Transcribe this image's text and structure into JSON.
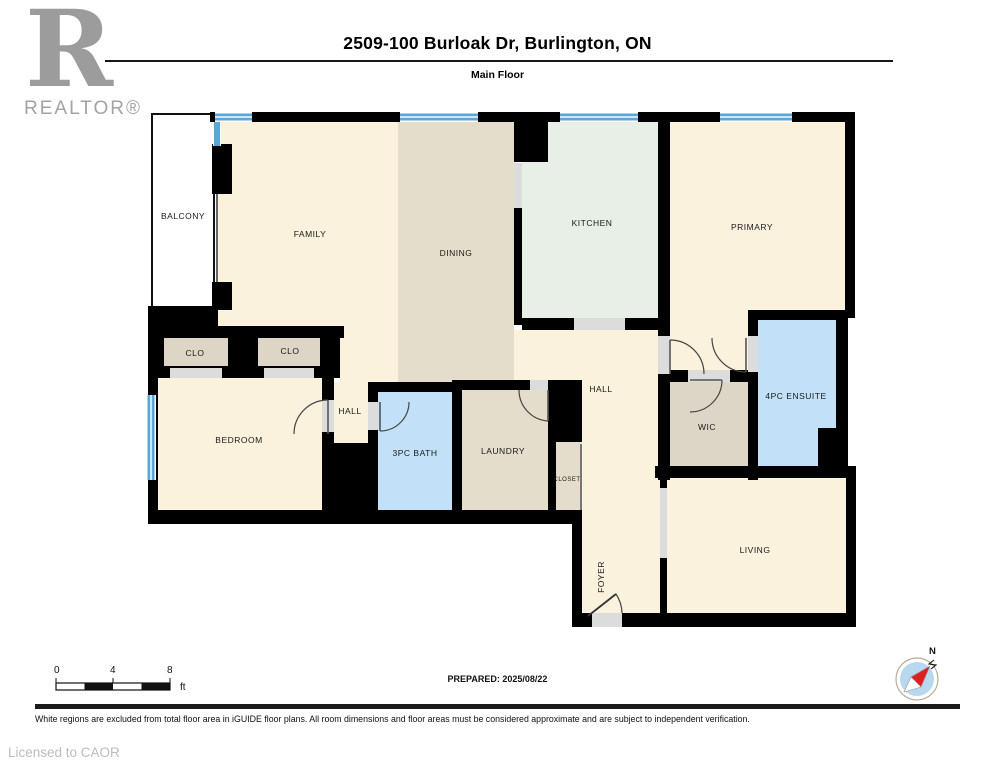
{
  "header": {
    "title": "2509-100 Burloak Dr, Burlington, ON",
    "subtitle": "Main Floor"
  },
  "branding": {
    "logo_letter": "R",
    "logo_wordmark": "REALTOR®",
    "licensed_to": "Licensed to CAOR"
  },
  "footer": {
    "prepared_label": "PREPARED: 2025/08/22",
    "disclaimer": "White regions are excluded from total floor area in iGUIDE floor plans. All room dimensions and floor areas must be considered approximate and are subject to independent verification.",
    "compass_label": "N"
  },
  "scale_bar": {
    "ticks": [
      "0",
      "4",
      "8"
    ],
    "unit": "ft"
  },
  "colors": {
    "white": "#ffffff",
    "cream": "#faf2dc",
    "tan": "#e5ddcb",
    "tan2": "#ddd5c6",
    "mint": "#e7efe6",
    "blue": "#c2e1f8",
    "window": "#5aa6d6",
    "window_light": "#cfe6f4",
    "wall": "#000000",
    "threshold": "#dcdcdc",
    "label_text": "#1a1a1a"
  },
  "floorplan": {
    "rooms": [
      {
        "name": "balcony",
        "label": "BALCONY",
        "rect": [
          152,
          114,
          62,
          196
        ],
        "color": "white",
        "outline": true,
        "label_pos": [
          183,
          219
        ]
      },
      {
        "name": "family",
        "label": "FAMILY",
        "rect": [
          218,
          122,
          180,
          206
        ],
        "color": "cream",
        "label_pos": [
          310,
          237
        ]
      },
      {
        "name": "family-passage",
        "label": "",
        "rect": [
          340,
          326,
          58,
          64
        ],
        "color": "cream"
      },
      {
        "name": "dining",
        "label": "DINING",
        "rect": [
          398,
          122,
          116,
          260
        ],
        "color": "tan",
        "label_pos": [
          456,
          256
        ]
      },
      {
        "name": "kitchen",
        "label": "KITCHEN",
        "rect": [
          522,
          122,
          136,
          196
        ],
        "color": "mint",
        "label_pos": [
          592,
          226
        ]
      },
      {
        "name": "primary",
        "label": "PRIMARY",
        "points": "670,122 845,122 845,310 748,310 748,372 670,372",
        "color": "cream",
        "label_pos": [
          752,
          230
        ]
      },
      {
        "name": "hall-main",
        "label": "HALL",
        "rect": [
          514,
          330,
          144,
          136
        ],
        "color": "cream",
        "label_pos": [
          601,
          392
        ]
      },
      {
        "name": "foyer",
        "label": "FOYER",
        "rect": [
          582,
          466,
          78,
          149
        ],
        "color": "cream",
        "label_pos": [
          604,
          577
        ],
        "rotate": -90
      },
      {
        "name": "closet-1",
        "label": "CLO",
        "rect": [
          162,
          332,
          66,
          40
        ],
        "color": "tan2",
        "label_pos": [
          195,
          356
        ]
      },
      {
        "name": "closet-2",
        "label": "CLO",
        "rect": [
          258,
          332,
          64,
          40
        ],
        "color": "tan2",
        "label_pos": [
          290,
          354
        ]
      },
      {
        "name": "bedroom",
        "label": "BEDROOM",
        "rect": [
          158,
          378,
          164,
          134
        ],
        "color": "cream",
        "label_pos": [
          239,
          443
        ]
      },
      {
        "name": "hall-bedroom",
        "label": "HALL",
        "rect": [
          332,
          382,
          38,
          61
        ],
        "color": "cream",
        "label_pos": [
          350,
          414
        ]
      },
      {
        "name": "bath-3pc",
        "label": "3PC BATH",
        "rect": [
          378,
          392,
          74,
          120
        ],
        "color": "blue",
        "label_pos": [
          415,
          456
        ]
      },
      {
        "name": "laundry",
        "label": "LAUNDRY",
        "rect": [
          462,
          390,
          86,
          122
        ],
        "color": "tan",
        "label_pos": [
          503,
          454
        ]
      },
      {
        "name": "closet-foyer",
        "label": "CLOSET",
        "rect": [
          554,
          442,
          27,
          70
        ],
        "color": "tan",
        "label_pos": [
          567,
          481
        ],
        "label_size": 6
      },
      {
        "name": "wic",
        "label": "WIC",
        "rect": [
          670,
          382,
          78,
          84
        ],
        "color": "tan2",
        "label_pos": [
          707,
          430
        ]
      },
      {
        "name": "ensuite-4pc",
        "label": "4PC ENSUITE",
        "points": "758,320 836,320 836,430 820,430 820,466 758,466",
        "color": "blue",
        "label_pos": [
          796,
          399
        ]
      },
      {
        "name": "living",
        "label": "LIVING",
        "rect": [
          667,
          478,
          180,
          137
        ],
        "color": "cream",
        "label_pos": [
          755,
          553
        ]
      }
    ]
  }
}
